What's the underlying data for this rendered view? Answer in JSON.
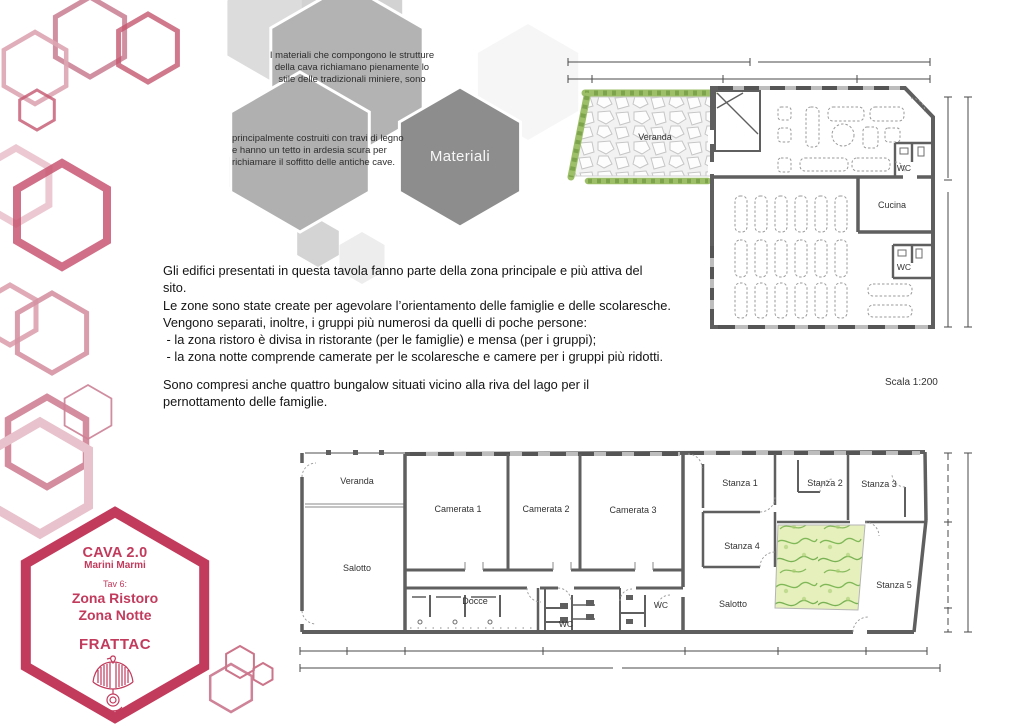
{
  "materials_diagram": {
    "hex1_lines": [
      "I materiali che compongono le strutture",
      "della cava richiamano pienamente lo",
      "stile delle tradizionali miniere, sono"
    ],
    "hex2_lines": [
      "principalmente costruiti con travi di legno",
      "e hanno un tetto in ardesia scura per",
      "richiamare il soffitto delle antiche cave."
    ],
    "hex3_label": "Materiali"
  },
  "intro": {
    "lines": [
      "Gli edifici presentati in questa tavola fanno parte della zona principale e più attiva del",
      "sito.",
      "Le zone sono state create per agevolare l’orientamento delle famiglie e delle scolaresche.",
      "Vengono separati, inoltre, i gruppi più numerosi da quelli di poche persone:",
      " - la zona ristoro è divisa in ristorante (per le famiglie) e mensa (per i gruppi);",
      " - la zona notte comprende camerate per le scolaresche e camere per i gruppi più ridotti.",
      "",
      "Sono compresi anche quattro bungalow situati vicino alla riva del lago per il",
      "pernottamento delle famiglie."
    ]
  },
  "scale_note": "Scala 1:200",
  "plan_top": {
    "labels": {
      "veranda": "Veranda",
      "wc_upper": "WC",
      "cucina": "Cucina",
      "wc_lower": "WC"
    }
  },
  "plan_bottom": {
    "labels": {
      "veranda": "Veranda",
      "camerata1": "Camerata 1",
      "camerata2": "Camerata 2",
      "camerata3": "Camerata 3",
      "salotto_left": "Salotto",
      "docce": "Docce",
      "wc_left": "WC",
      "wc_right": "WC",
      "stanza1": "Stanza 1",
      "stanza2": "Stanza 2",
      "stanza3": "Stanza 3",
      "stanza4": "Stanza 4",
      "salotto_right": "Salotto",
      "stanza5": "Stanza 5"
    }
  },
  "title_block": {
    "project": "CAVA 2.0",
    "client": "Marini Marmi",
    "sheet": "Tav 6:",
    "zone_line1": "Zona Ristoro",
    "zone_line2": "Zona Notte",
    "studio": "FRATTAC"
  },
  "icons": {
    "eagle_logo": "eagle"
  },
  "colors": {
    "accent_crimson": "#c23a5c",
    "hex_gray": "#b3b3b3",
    "hex_gray_dark": "#8d8d8d",
    "plan_wall": "#5f5f5f",
    "hedge_green": "#8fb95e",
    "courtyard_green": "#cfe49a"
  }
}
